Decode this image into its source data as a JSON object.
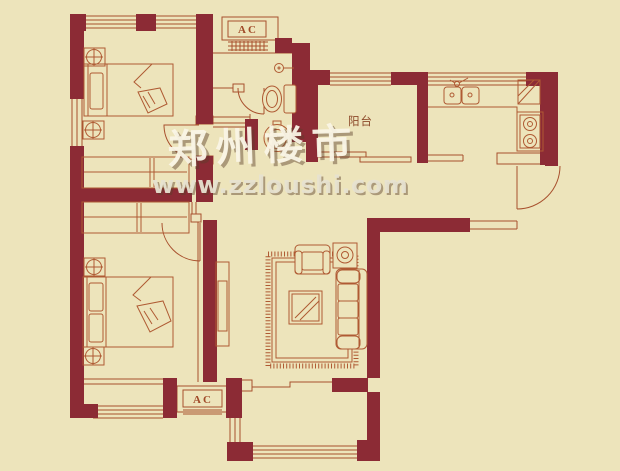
{
  "figure": {
    "type": "apartment floor plan",
    "width": 620,
    "height": 471
  },
  "labels": {
    "ac_top": "AC",
    "balcony": "阳台",
    "ac_bottom": "AC"
  },
  "watermark": {
    "brand": "郑州楼市",
    "url": "www.zzloushi.com"
  },
  "colors": {
    "background": "#EDE4BB",
    "wall": "#8C2B35",
    "line": "#A8502D",
    "furniture_line": "#AF5A33",
    "watermark_text": "#FAF5E6"
  }
}
